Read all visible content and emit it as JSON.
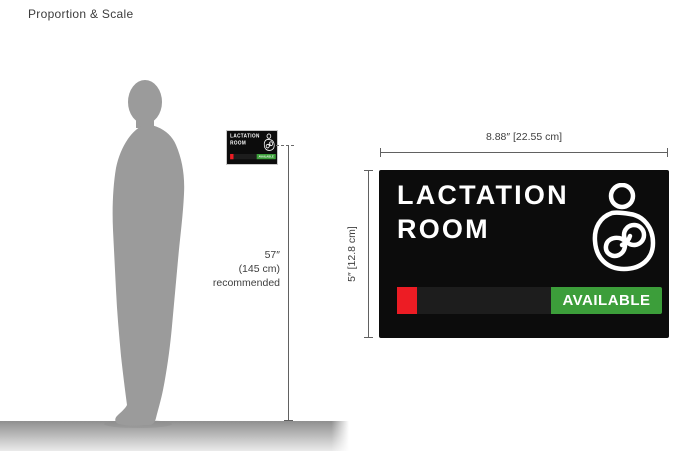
{
  "page": {
    "title": "Proportion & Scale"
  },
  "sign": {
    "title_line1": "LACTATION",
    "title_line2": "ROOM",
    "status_label": "AVAILABLE",
    "icon": "breastfeeding-icon"
  },
  "dimensions": {
    "sign_width_label": "8.88″ [22.55 cm]",
    "sign_height_label": "5″ [12.8 cm]",
    "mounting_height": {
      "value": "57″",
      "metric": "(145 cm)",
      "note": "recommended"
    }
  },
  "colors": {
    "accent_red": "#ed1c24",
    "accent_green": "#3c9e3a",
    "sign_background": "#0c0c0c",
    "sign_text": "#ffffff",
    "slider_track": "#1d1d1d",
    "silhouette_gray": "#9b9b9b",
    "dimension_line": "#616161",
    "dimension_text": "#3f3f3f",
    "floor_top": "#8f8f8f",
    "floor_bottom": "#ebebeb"
  }
}
